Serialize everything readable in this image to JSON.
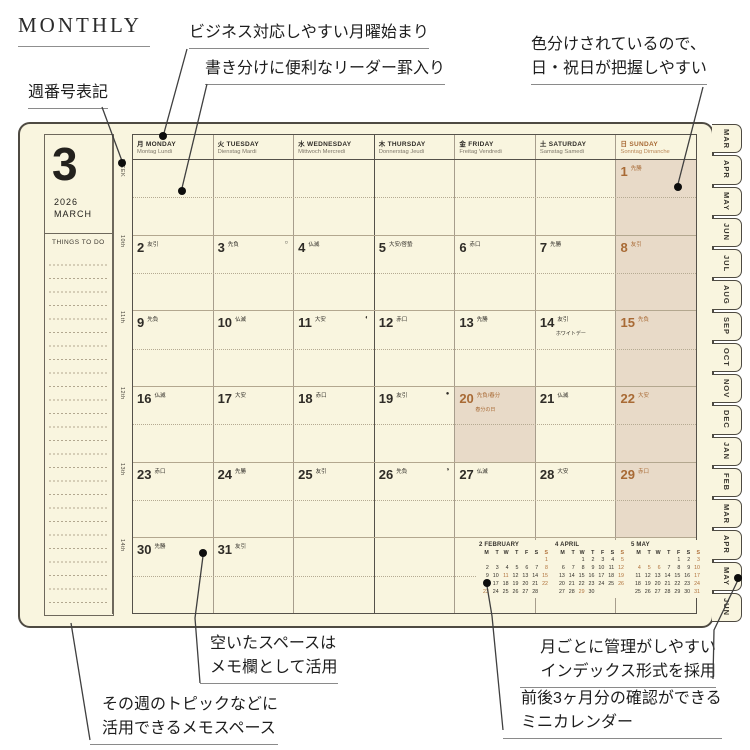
{
  "title": "MONTHLY",
  "annotations": {
    "week_number": "週番号表記",
    "monday_start": "ビジネス対応しやすい月曜始まり",
    "leader_rule": "書き分けに便利なリーダー罫入り",
    "color_coded_1": "色分けされているので、",
    "color_coded_2": "日・祝日が把握しやすい",
    "memo_space_1": "空いたスペースは",
    "memo_space_2": "メモ欄として活用",
    "weekly_topic_1": "その週のトピックなどに",
    "weekly_topic_2": "活用できるメモスペース",
    "index_tabs_1": "月ごとに管理がしやすい",
    "index_tabs_2": "インデックス形式を採用",
    "mini_calendar_1": "前後3ヶ月分の確認ができる",
    "mini_calendar_2": "ミニカレンダー"
  },
  "planner": {
    "month_number": "3",
    "year": "2026",
    "month_name": "MARCH",
    "things_to_do": "THINGS TO DO",
    "week_header_label": "WEEK",
    "week_labels": [
      "10th",
      "11th",
      "12th",
      "13th",
      "14th"
    ],
    "day_headers": [
      {
        "prefix": "月",
        "name": "MONDAY",
        "sub": "Montag Lundi",
        "accent": false
      },
      {
        "prefix": "火",
        "name": "TUESDAY",
        "sub": "Dienstag Mardi",
        "accent": false
      },
      {
        "prefix": "水",
        "name": "WEDNESDAY",
        "sub": "Mittwoch Mercredi",
        "accent": false
      },
      {
        "prefix": "木",
        "name": "THURSDAY",
        "sub": "Donnerstag Jeudi",
        "accent": false
      },
      {
        "prefix": "金",
        "name": "FRIDAY",
        "sub": "Freitag Vendredi",
        "accent": false
      },
      {
        "prefix": "土",
        "name": "SATURDAY",
        "sub": "Samstag Samedi",
        "accent": false
      },
      {
        "prefix": "日",
        "name": "SUNDAY",
        "sub": "Sonntag Dimanche",
        "accent": true
      }
    ],
    "weeks": [
      [
        null,
        null,
        null,
        null,
        null,
        null,
        {
          "date": 1,
          "note": "先勝"
        }
      ],
      [
        {
          "date": 2,
          "note": "友引"
        },
        {
          "date": 3,
          "note": "先負",
          "moon": "○"
        },
        {
          "date": 4,
          "note": "仏滅"
        },
        {
          "date": 5,
          "note": "大安/啓蟄"
        },
        {
          "date": 6,
          "note": "赤口"
        },
        {
          "date": 7,
          "note": "先勝"
        },
        {
          "date": 8,
          "note": "友引"
        }
      ],
      [
        {
          "date": 9,
          "note": "先負"
        },
        {
          "date": 10,
          "note": "仏滅"
        },
        {
          "date": 11,
          "note": "大安",
          "moon": "◐"
        },
        {
          "date": 12,
          "note": "赤口"
        },
        {
          "date": 13,
          "note": "先勝"
        },
        {
          "date": 14,
          "note": "友引",
          "note2": "ホワイトデー"
        },
        {
          "date": 15,
          "note": "先負"
        }
      ],
      [
        {
          "date": 16,
          "note": "仏滅"
        },
        {
          "date": 17,
          "note": "大安"
        },
        {
          "date": 18,
          "note": "赤口"
        },
        {
          "date": 19,
          "note": "友引",
          "moon": "●"
        },
        {
          "date": 20,
          "note": "先負/春分",
          "note2": "春分の日",
          "holiday": true
        },
        {
          "date": 21,
          "note": "仏滅"
        },
        {
          "date": 22,
          "note": "大安"
        }
      ],
      [
        {
          "date": 23,
          "note": "赤口"
        },
        {
          "date": 24,
          "note": "先勝"
        },
        {
          "date": 25,
          "note": "友引"
        },
        {
          "date": 26,
          "note": "先負",
          "moon": "◑"
        },
        {
          "date": 27,
          "note": "仏滅"
        },
        {
          "date": 28,
          "note": "大安"
        },
        {
          "date": 29,
          "note": "赤口"
        }
      ],
      [
        {
          "date": 30,
          "note": "先勝"
        },
        {
          "date": 31,
          "note": "友引"
        },
        null,
        null,
        null,
        null,
        null
      ]
    ],
    "tabs": [
      "MAR",
      "APR",
      "MAY",
      "JUN",
      "JUL",
      "AUG",
      "SEP",
      "OCT",
      "NOV",
      "DEC",
      "JAN",
      "FEB",
      "MAR",
      "APR",
      "MAY",
      "JUN"
    ],
    "mini_calendars": [
      {
        "title": "2 FEBRUARY",
        "dow": [
          "M",
          "T",
          "W",
          "T",
          "F",
          "S",
          "S"
        ],
        "weeks": [
          [
            "",
            "",
            "",
            "",
            "",
            "",
            "1"
          ],
          [
            "2",
            "3",
            "4",
            "5",
            "6",
            "7",
            "8"
          ],
          [
            "9",
            "10",
            "11",
            "12",
            "13",
            "14",
            "15"
          ],
          [
            "16",
            "17",
            "18",
            "19",
            "20",
            "21",
            "22"
          ],
          [
            "23",
            "24",
            "25",
            "26",
            "27",
            "28",
            ""
          ]
        ],
        "accent": [
          1,
          8,
          11,
          15,
          22,
          23
        ]
      },
      {
        "title": "4 APRIL",
        "dow": [
          "M",
          "T",
          "W",
          "T",
          "F",
          "S",
          "S"
        ],
        "weeks": [
          [
            "",
            "",
            "1",
            "2",
            "3",
            "4",
            "5"
          ],
          [
            "6",
            "7",
            "8",
            "9",
            "10",
            "11",
            "12"
          ],
          [
            "13",
            "14",
            "15",
            "16",
            "17",
            "18",
            "19"
          ],
          [
            "20",
            "21",
            "22",
            "23",
            "24",
            "25",
            "26"
          ],
          [
            "27",
            "28",
            "29",
            "30",
            "",
            "",
            ""
          ]
        ],
        "accent": [
          5,
          12,
          19,
          26,
          29
        ]
      },
      {
        "title": "5 MAY",
        "dow": [
          "M",
          "T",
          "W",
          "T",
          "F",
          "S",
          "S"
        ],
        "weeks": [
          [
            "",
            "",
            "",
            "",
            "1",
            "2",
            "3"
          ],
          [
            "4",
            "5",
            "6",
            "7",
            "8",
            "9",
            "10"
          ],
          [
            "11",
            "12",
            "13",
            "14",
            "15",
            "16",
            "17"
          ],
          [
            "18",
            "19",
            "20",
            "21",
            "22",
            "23",
            "24"
          ],
          [
            "25",
            "26",
            "27",
            "28",
            "29",
            "30",
            "31"
          ]
        ],
        "accent": [
          3,
          4,
          5,
          6,
          10,
          17,
          24,
          31
        ]
      }
    ]
  },
  "colors": {
    "page_cream": "#f9f5df",
    "sunday_shade": "#e8dac8",
    "accent_rust": "#a86a35",
    "ink": "#2f2c27",
    "grid_dark": "#55514a",
    "grid_light": "#a79d8c"
  }
}
